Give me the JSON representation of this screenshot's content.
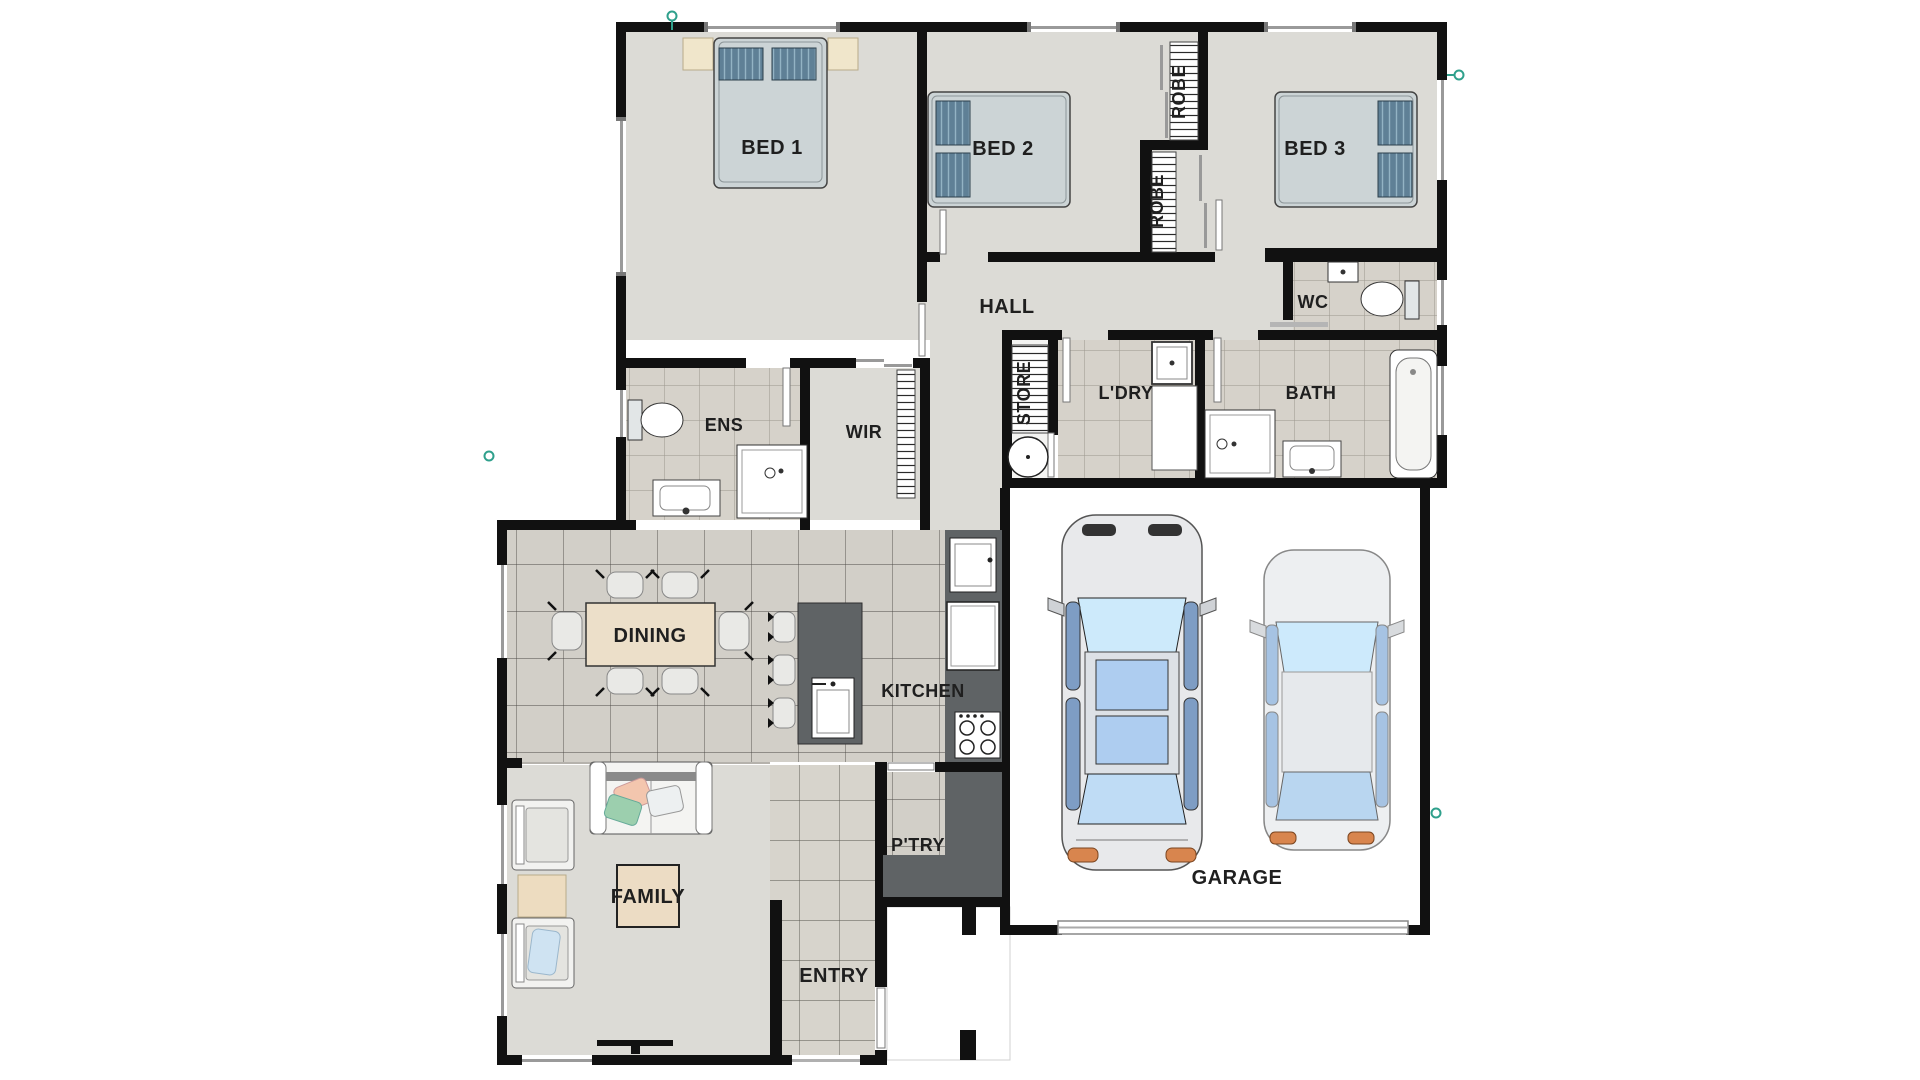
{
  "title": "Single-storey house floor plan with double garage",
  "rooms": {
    "bed1": "BED 1",
    "bed2": "BED 2",
    "bed3": "BED 3",
    "robe_a": "ROBE",
    "robe_b": "ROBE",
    "hall": "HALL",
    "wc": "WC",
    "ens": "ENS",
    "wir": "WIR",
    "store": "STORE",
    "ldry": "L'DRY",
    "bath": "BATH",
    "dining": "DINING",
    "kitchen": "KITCHEN",
    "ptry": "P'TRY",
    "family": "FAMILY",
    "entry": "ENTRY",
    "garage": "GARAGE"
  },
  "colors": {
    "wall": "#111111",
    "carpet": "#dcdbd6",
    "tile_bath": "#d6d2ca",
    "tile_kitchen": "#d2cfc8",
    "tile_entry": "#d7d4cc",
    "cabinet_dark": "#5f6365",
    "table_cream": "#ecdfc9",
    "bed_linen": "#ccd4d6",
    "pillow_blue": "#5f8096",
    "glass_blue": "#cdeafb",
    "taillight_orange": "#d8854e",
    "marker_teal": "#2fa08c",
    "label_text": "#1f1f1f"
  }
}
